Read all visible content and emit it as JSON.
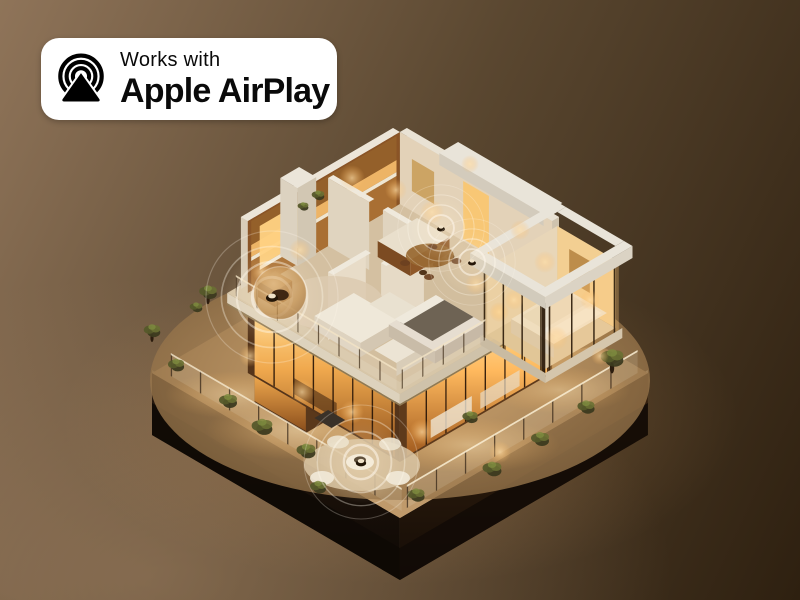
{
  "badge": {
    "line1": "Works with",
    "line2": "Apple AirPlay",
    "icon": "airplay-icon"
  },
  "colors": {
    "bg-dark": "#2e2010",
    "bg-mid": "#5a4730",
    "bg-light": "#8f7459",
    "badge-bg": "#ffffff",
    "badge-text": "#0a0a0a",
    "glow-warm": "#f3a94e",
    "window-amber": "#f6bc66",
    "roof-white": "#e9e4d9",
    "wall-cream": "#ddd1bc",
    "terrace-tan": "#c09a6b",
    "plinth-dark": "#1c110a",
    "ripple-white": "#fff8ec",
    "plant-green": "#5a5f2b",
    "wood-warm": "#8a5426"
  }
}
